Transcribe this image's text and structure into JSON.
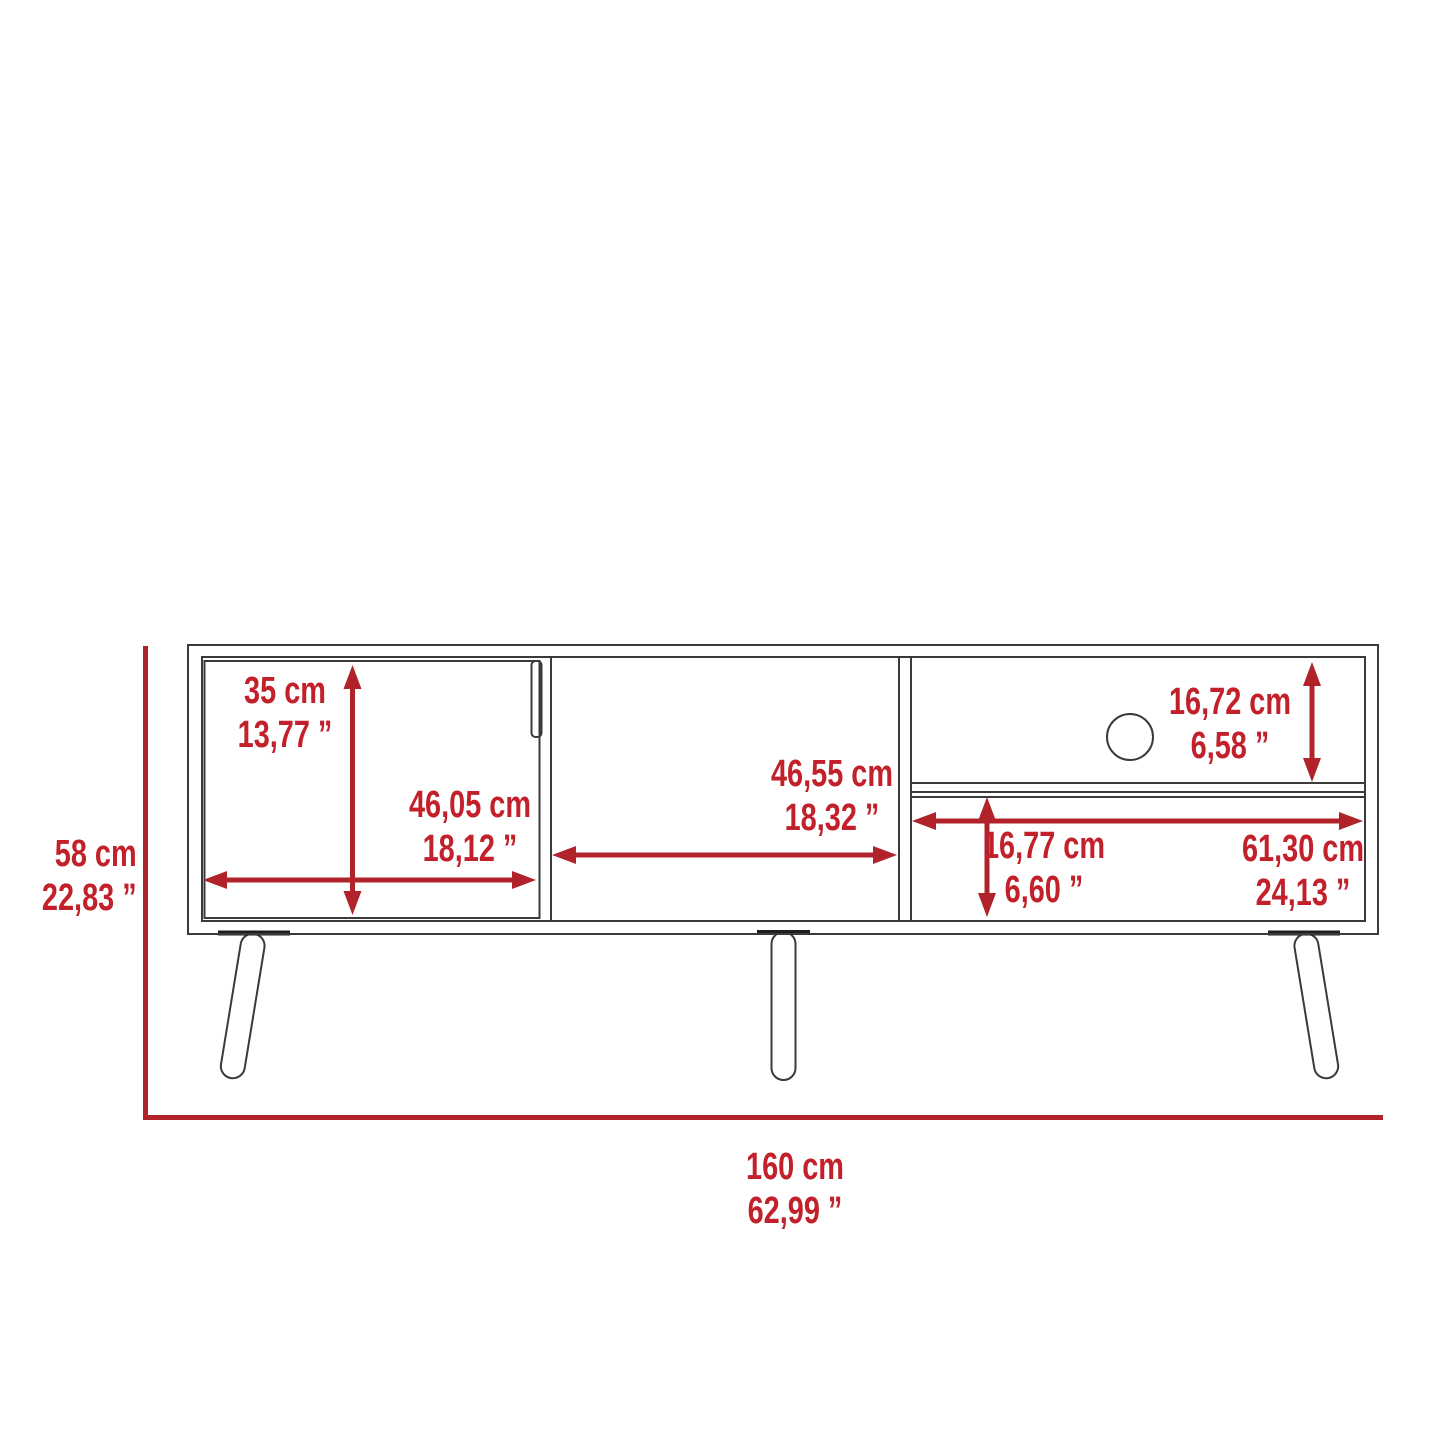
{
  "diagram": {
    "subject": "tv-stand-dimension-drawing",
    "units": [
      "cm",
      "inches"
    ]
  },
  "dimensions": {
    "overall_height": {
      "cm": "58 cm",
      "inches": "22,83 ”"
    },
    "overall_width": {
      "cm": "160 cm",
      "inches": "62,99 ”"
    },
    "left_door_height": {
      "cm": "35 cm",
      "inches": "13,77 ”"
    },
    "left_door_width": {
      "cm": "46,05 cm",
      "inches": "18,12 ”"
    },
    "middle_compartment_width": {
      "cm": "46,55 cm",
      "inches": "18,32 ”"
    },
    "top_shelf_height": {
      "cm": "16,72 cm",
      "inches": "6,58 ”"
    },
    "bottom_shelf_height": {
      "cm": "16,77 cm",
      "inches": "6,60 ”"
    },
    "bottom_shelf_width": {
      "cm": "61,30 cm",
      "inches": "24,13 ”"
    }
  },
  "colors": {
    "background": "#ffffff",
    "drawing_line": "#3a3a3a",
    "dimension_line": "#b0232a",
    "dimension_text": "#c2202a",
    "leg_mount": "#1e1e1e"
  }
}
